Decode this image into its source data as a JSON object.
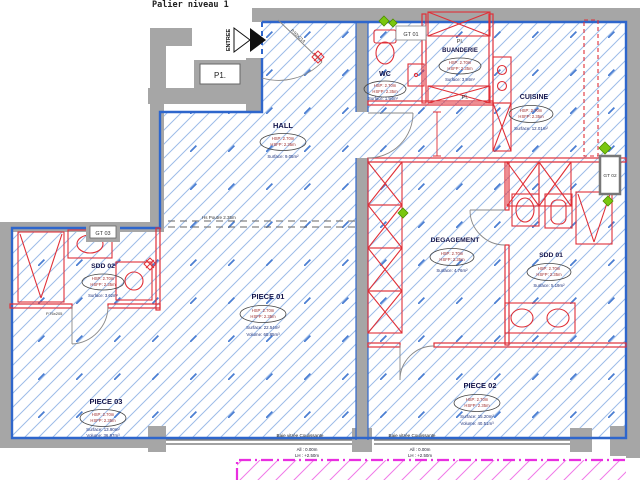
{
  "title": "Palier niveau 1",
  "annotations": {
    "entree": "ENTREE",
    "p1": "P1.",
    "pl": "Pl.",
    "gt01": "GT 01",
    "gt02": "GT 02",
    "gt03": "GT 03",
    "entry_door": "P.93x214",
    "sdd02_door": "P.76x205",
    "beam": "Hs Poutre 2.35m"
  },
  "rooms": [
    {
      "name": "HALL",
      "hsp": "HSP: 2.70m",
      "hsfp": "HSFP: 2.35m",
      "surface": "Surface: 9.05m²"
    },
    {
      "name": "WC",
      "hsp": "HSP: 2.70m",
      "hsfp": "HSFP: 2.35m",
      "surface": "Surface: 1.94m²"
    },
    {
      "name": "BUANDERIE",
      "hsp": "HSP: 2.70m",
      "hsfp": "HSFP: 2.35m",
      "surface": "Surface: 3.94m²"
    },
    {
      "name": "CUISINE",
      "hsp": "HSP: 2.70m",
      "hsfp": "HSFP: 2.35m",
      "surface": "Surface: 12.01m²"
    },
    {
      "name": "DEGAGEMENT",
      "hsp": "HSP: 2.70m",
      "hsfp": "HSFP: 2.35m",
      "surface": "Surface: 4.76m²"
    },
    {
      "name": "SDD 01",
      "hsp": "HSP: 2.70m",
      "hsfp": "HSFP: 2.35m",
      "surface": "Surface: 5.19m²"
    },
    {
      "name": "SDD 02",
      "hsp": "HSP: 2.70m",
      "hsfp": "HSFP: 2.35m",
      "surface": "Surface: 3.62m²"
    },
    {
      "name": "PIECE 01",
      "hsp": "HSP: 2.70m",
      "hsfp": "HSFP: 2.35m",
      "surface": "Surface: 22.54m²",
      "volume": "Volume: 60.85m³"
    },
    {
      "name": "PIECE 02",
      "hsp": "HSP: 2.70m",
      "hsfp": "HSFP: 2.35m",
      "surface": "Surface: 15.20m²",
      "volume": "Volume: 40.51m³"
    },
    {
      "name": "PIECE 03",
      "hsp": "HSP: 2.70m",
      "hsfp": "HSFP: 2.35m",
      "surface": "Surface: 13.90m²",
      "volume": "Volume: 36.97m³"
    }
  ],
  "windows": {
    "label": "Baie vitrée Coulissante",
    "all": "All : 0.00m",
    "lh": "LH : +2.50m"
  },
  "colors": {
    "wall_gray": "#a6a6a6",
    "perimeter_blue": "#2e66cc",
    "hatch_blue": "#88aee0",
    "partition_red": "#e03038",
    "balcony_magenta": "#e92ee0",
    "marker_green": "#7ac70f"
  }
}
